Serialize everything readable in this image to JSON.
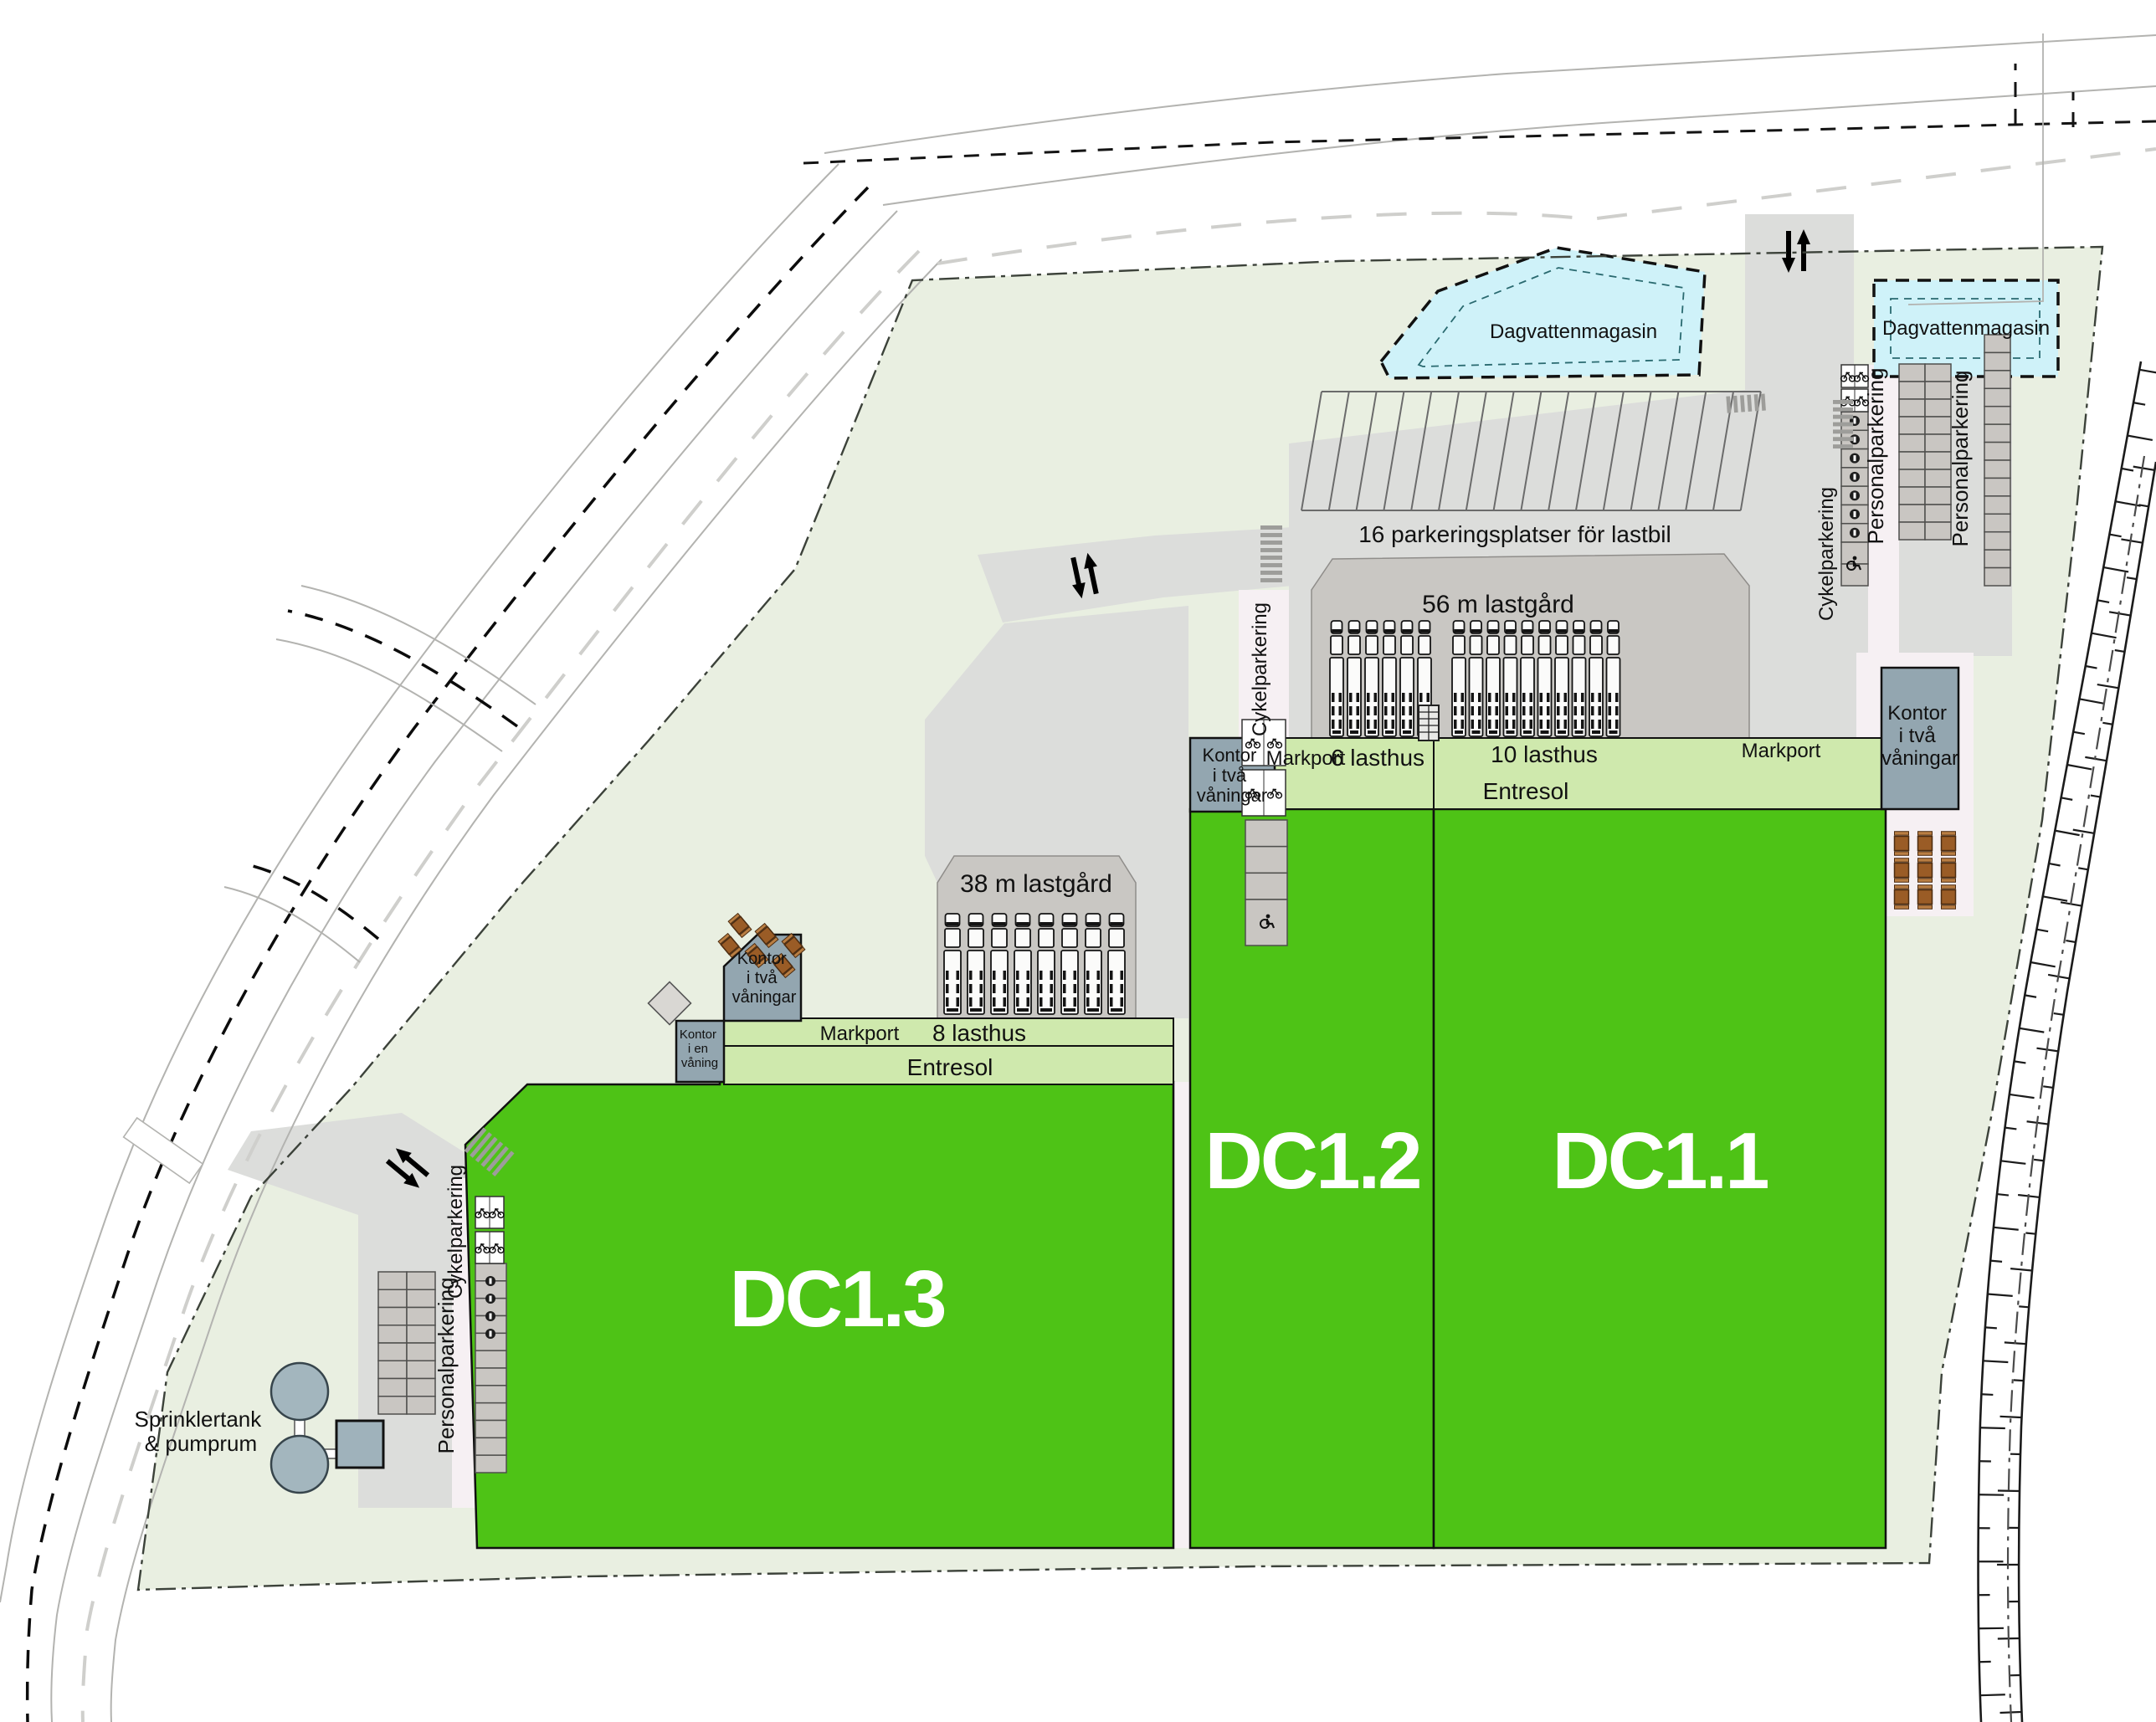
{
  "site": {
    "buildings": [
      {
        "id": "dc13",
        "label": "DC1.3",
        "entresol": "Entresol",
        "markport": "Markport",
        "lasthus": "8 lasthus",
        "office_two": [
          "Kontor",
          "i två",
          "våningar"
        ],
        "office_one": [
          "Kontor",
          "i en",
          "våning"
        ]
      },
      {
        "id": "dc12",
        "label": "DC1.2",
        "markport": "Markport",
        "lasthus": "6 lasthus",
        "office_two": [
          "Kontor",
          "i två",
          "våningar"
        ]
      },
      {
        "id": "dc11",
        "label": "DC1.1",
        "entresol": "Entresol",
        "markport": "Markport",
        "lasthus": "10 lasthus",
        "office_two": [
          "Kontor",
          "i två",
          "våningar"
        ]
      }
    ],
    "areas": {
      "truck_parking_label": "16 parkeringsplatser för lastbil",
      "yard_56_label": "56 m lastgård",
      "yard_38_label": "38 m lastgård",
      "stormwater_west_label": "Dagvattenmagasin",
      "stormwater_east_label": "Dagvattenmagasin",
      "staff_parking_sw_label": "Personalparkering",
      "staff_parking_ne_west_label": "Personalparkering",
      "staff_parking_ne_east_label": "Personalparkering",
      "bike_parking_sw_label": "Cykelparkering",
      "bike_parking_mid_label": "Cykelparkering",
      "bike_parking_ne_label": "Cykelparkering",
      "sprinkler_label": [
        "Sprinklertank",
        "& pumprum"
      ]
    },
    "counts": {
      "truck_parking_spaces": 16,
      "dc13_lasthus": 8,
      "dc12_lasthus": 6,
      "dc11_lasthus": 10,
      "yard38_trucks": 8,
      "yard56_trucks_west": 6,
      "yard56_trucks_east": 10
    },
    "colors": {
      "building_green": "#4ec316",
      "entresol_green": "#cfe9ad",
      "site_green": "#e9efe1",
      "road_gray": "#dcdddb",
      "yard_gray": "#c9c7c3",
      "office_gray": "#93a6b0",
      "water_blue": "#cff2f9",
      "table_brown": "#9a5c26"
    }
  }
}
